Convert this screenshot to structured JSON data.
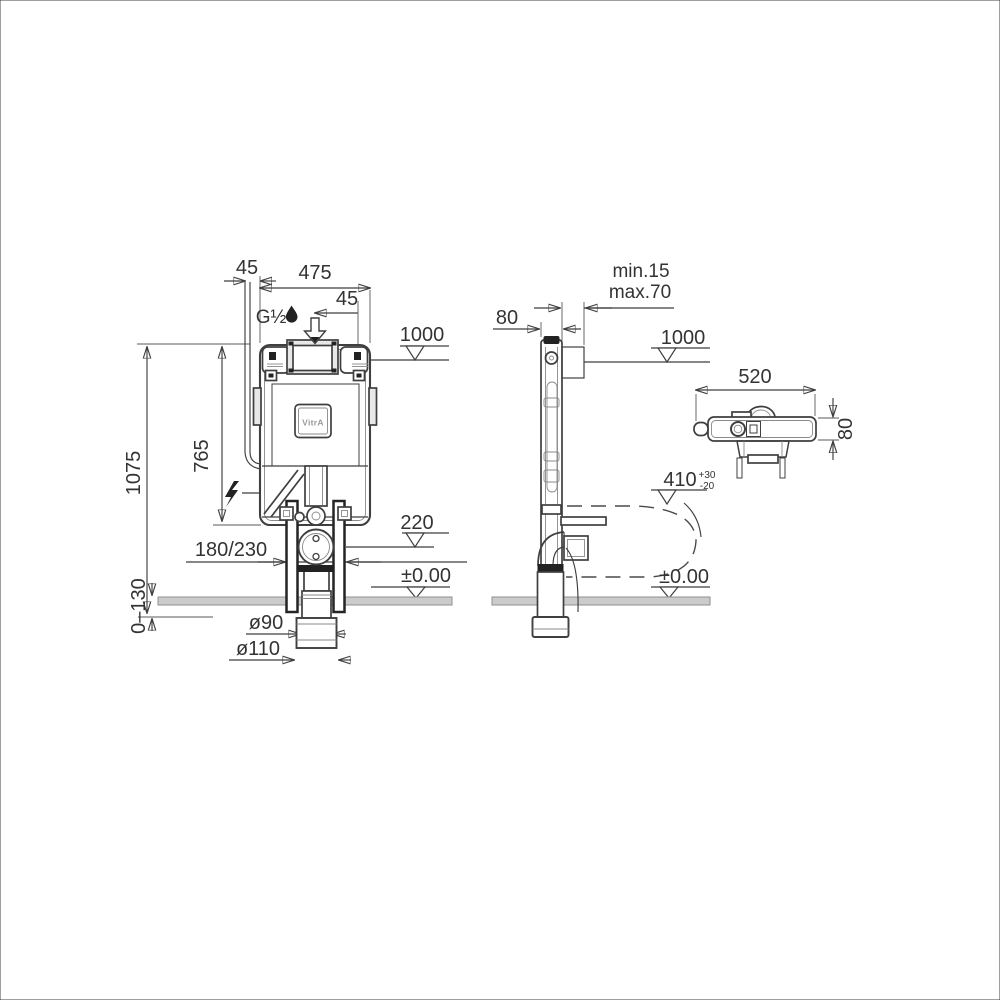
{
  "drawing": {
    "brand_logo": "VitrA",
    "front": {
      "conduit_offset": "45",
      "tank_width": "475",
      "inlet_offset": "45",
      "inlet_thread": "G½",
      "button_height_ref": "1000",
      "tank_height": "765",
      "total_height": "1075",
      "floor_buildup": "0–130",
      "outlet_spacing": "180/230",
      "outlet_height_ref": "220",
      "floor_level": "±0.00",
      "outlet_dia_small": "ø90",
      "outlet_dia_large": "ø110"
    },
    "side": {
      "frame_depth": "80",
      "wall_finish_min": "min.15",
      "wall_finish_max": "max.70",
      "button_height_ref": "1000",
      "pan_connection_height": "410",
      "pan_tol_plus": "+30",
      "pan_tol_minus": "-20",
      "floor_level": "±0.00"
    },
    "top": {
      "cistern_width": "520",
      "cistern_depth": "80"
    }
  }
}
